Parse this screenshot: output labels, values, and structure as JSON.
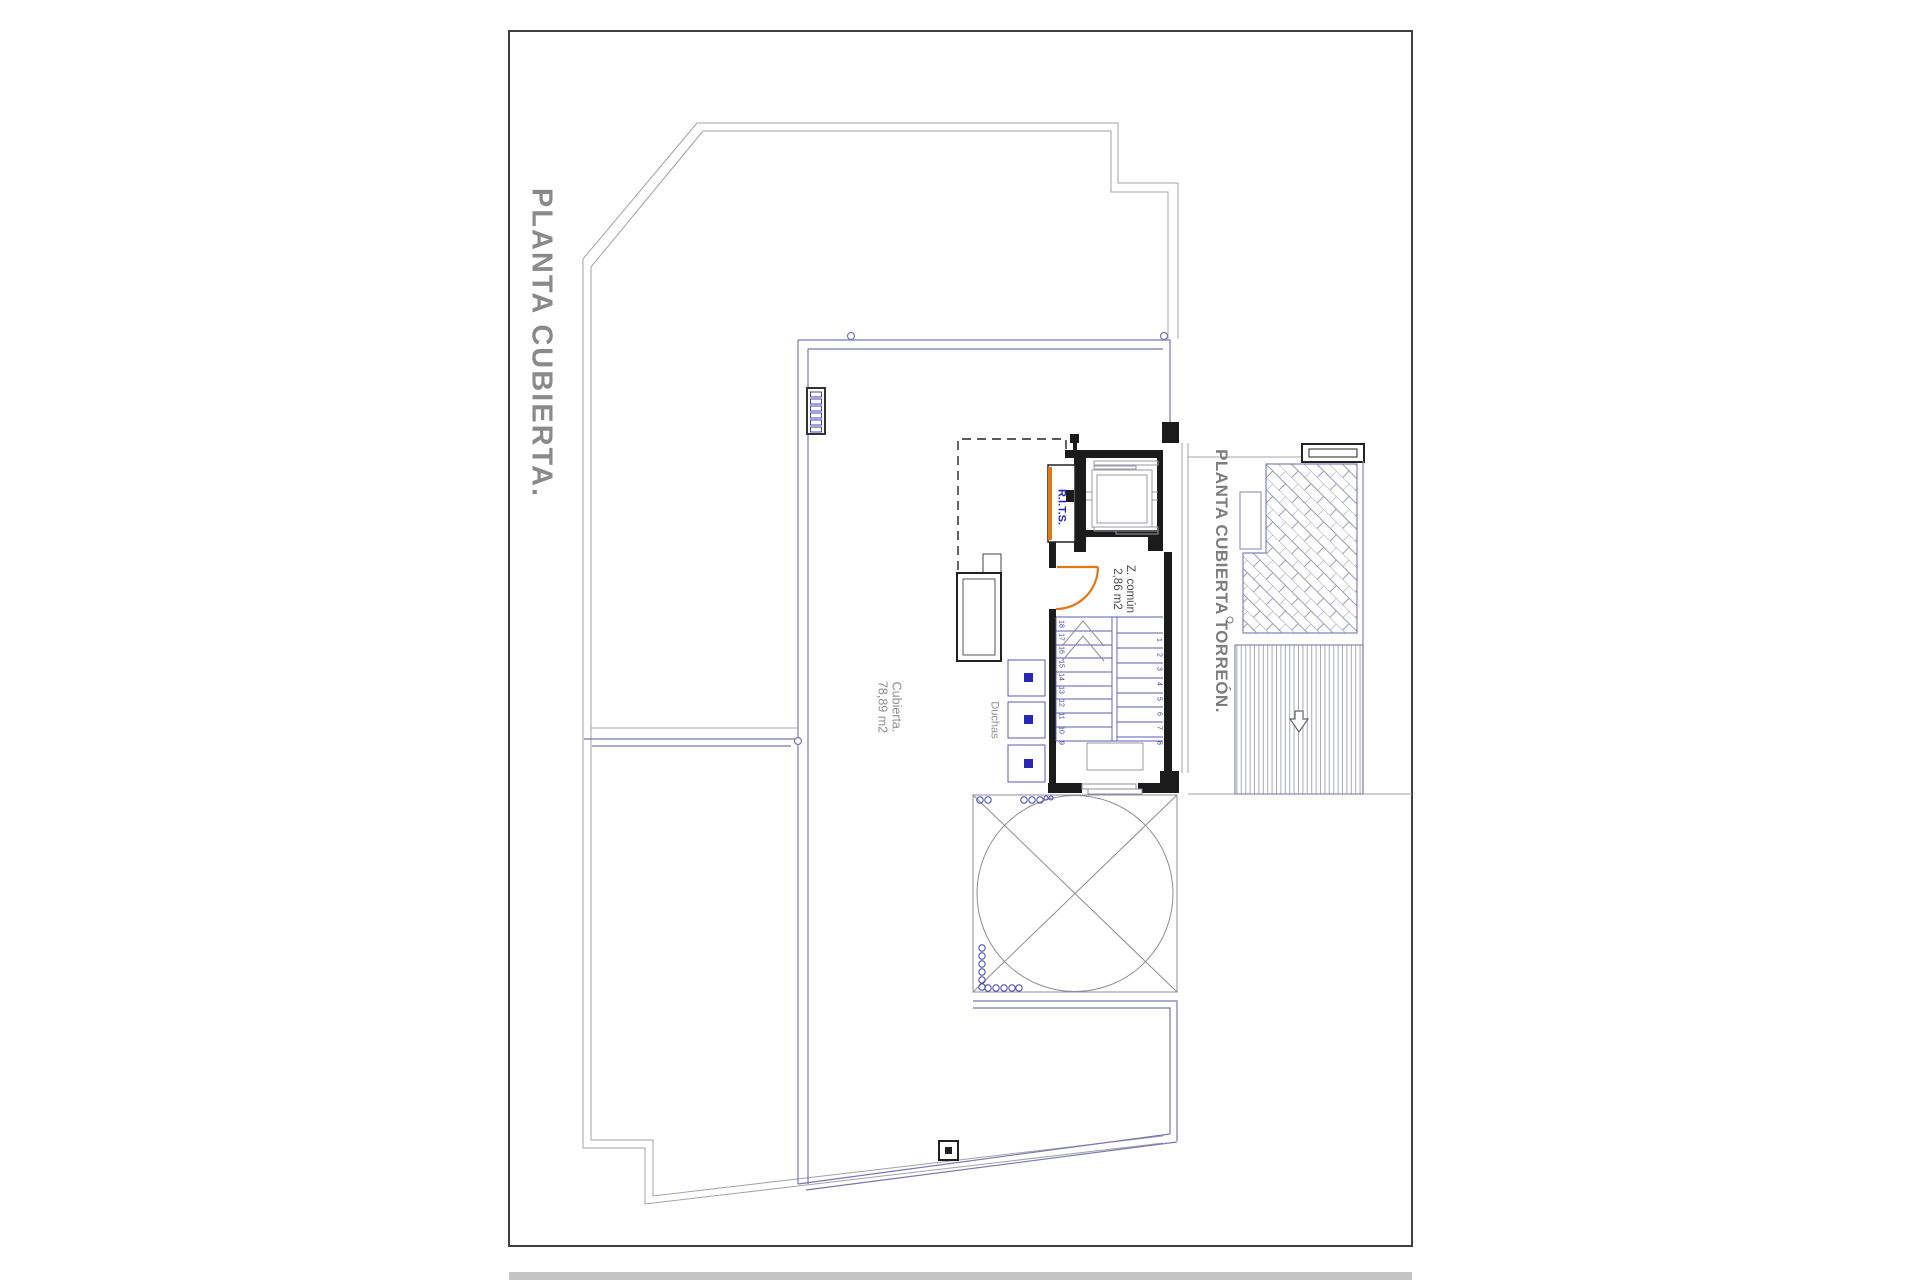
{
  "sheet": {
    "type": "architectural-plan",
    "background": "#ffffff",
    "border_color": "#3f3f3f"
  },
  "titles": {
    "main": "PLANTA CUBIERTA.",
    "torreon": "PLANTA CUBIERTA TORREÓN."
  },
  "labels": {
    "roof_area_name": "Cubierta.",
    "roof_area_size": "78,89 m2",
    "showers": "Duchas",
    "common_zone_name": "Z. común",
    "common_zone_size": "2,86 m2",
    "telecom_riser": "R.I.T.S."
  },
  "stairs": {
    "left_numbers": [
      "18",
      "17",
      "16",
      "15",
      "14",
      "13",
      "12",
      "11",
      "10",
      "9"
    ],
    "right_numbers": [
      "1",
      "2",
      "3",
      "4",
      "5",
      "6",
      "7",
      "8"
    ]
  },
  "colors": {
    "accent_orange": "#e07818",
    "roof_line_blue": "#7878ad",
    "detail_blue": "#4444aa",
    "outline_gray": "#a0a0ab",
    "wall_black": "#1b1b1b",
    "title_gray": "#8a8a8a",
    "rits_text_blue": "#2626bb"
  },
  "symbols": [
    {
      "name": "skylight-crossed-circle",
      "desc": "square with inscribed circle and corner diagonals"
    },
    {
      "name": "herringbone-paving",
      "desc": "45° brick paving on torreon roof"
    },
    {
      "name": "decking-stripes",
      "desc": "striped deck area with down arrow"
    },
    {
      "name": "drain-marker",
      "desc": "small square with filled center on lower roof edge"
    },
    {
      "name": "door-swing",
      "desc": "orange quarter-circle door arc"
    },
    {
      "name": "vent-grille",
      "desc": "ladder-like grille with six cells"
    }
  ]
}
